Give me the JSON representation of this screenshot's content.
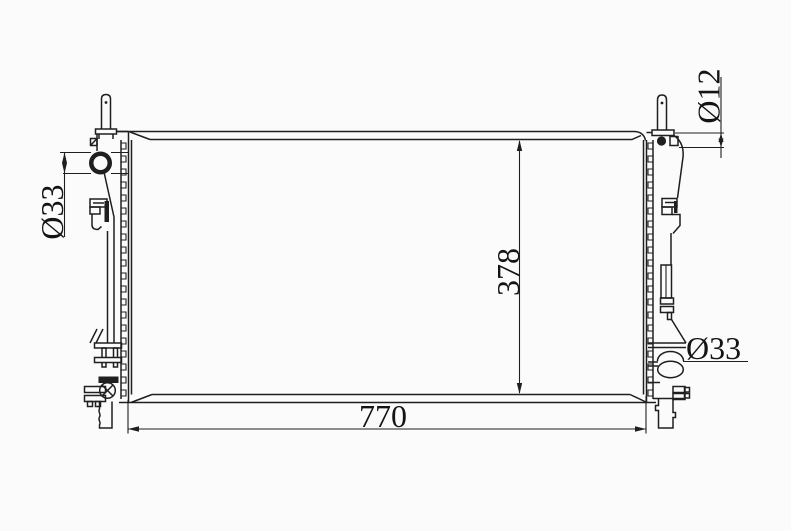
{
  "drawing": {
    "background_color": "#fbfbfb",
    "line_color": "#1f1f1f",
    "dimensions": {
      "core_width": "770",
      "core_height": "378",
      "inlet_port": "Ø33",
      "overflow_port": "Ø12",
      "outlet_port": "Ø33"
    }
  }
}
